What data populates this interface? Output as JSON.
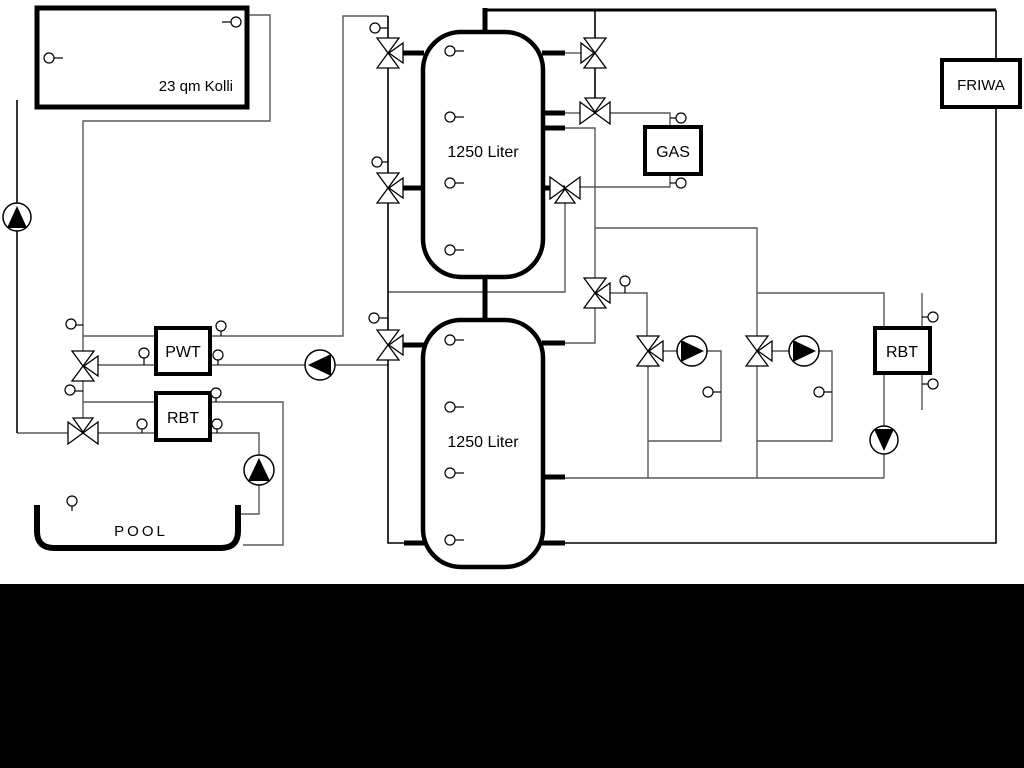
{
  "diagram": {
    "type": "hydraulic-heating-schematic",
    "labels": {
      "collector": "23 qm Kolli",
      "tank_top": "1250 Liter",
      "tank_bottom": "1250 Liter",
      "pwt": "PWT",
      "rbt_pool": "RBT",
      "gas": "GAS",
      "friwa": "FRIWA",
      "rbt_right": "RBT",
      "pool": "POOL"
    },
    "colors": {
      "background": "#ffffff",
      "line_gray": "#595959",
      "line_black": "#000000",
      "bottom_bar": "#000000"
    }
  }
}
